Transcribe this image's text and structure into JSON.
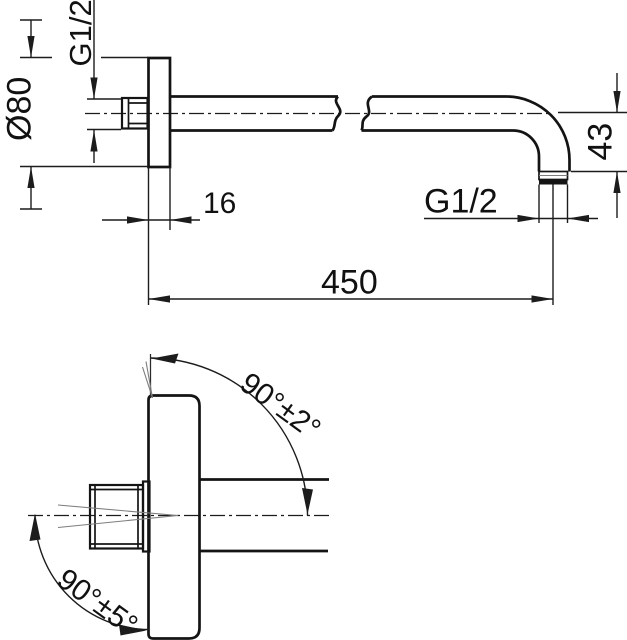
{
  "drawing": {
    "type": "technical-dimension-drawing",
    "views": {
      "side_view": "wall flange with shower arm, pipe break and 90-degree outlet bend",
      "front_view": "wall flange with thread nut and arm with angular tolerances"
    },
    "dimensions": {
      "flange_thread": "G1/2",
      "flange_diameter": "Ø80",
      "flange_depth": "16",
      "outlet_thread": "G1/2",
      "outlet_drop": "43",
      "arm_length": "450",
      "angle_top": "90°±2°",
      "angle_bottom": "90°±5°"
    },
    "colors": {
      "line": "#141414",
      "dimension_line": "#1c1c1c",
      "tolerance_line": "#7d7d7d",
      "background": "#ffffff"
    }
  }
}
